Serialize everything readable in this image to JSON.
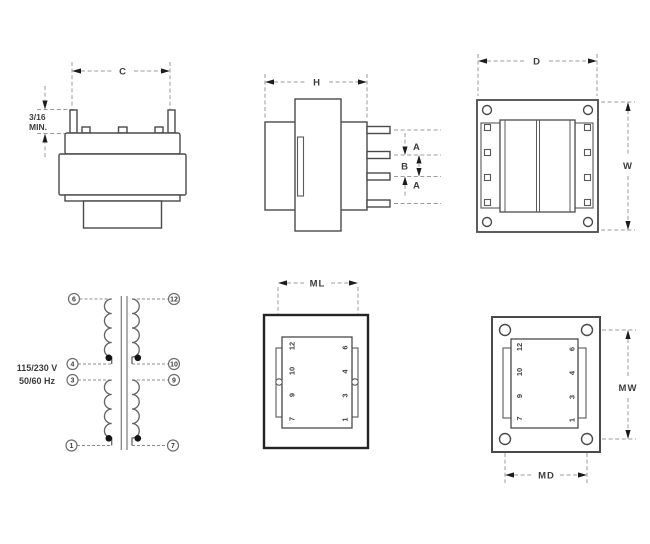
{
  "drawing": {
    "front_view": {
      "dim_width_label": "C",
      "min_lead_label_line1": "3/16",
      "min_lead_label_line2": "MIN."
    },
    "side_view": {
      "dim_length_label": "H",
      "pin_pitch_a_label": "A",
      "pin_pitch_b_label": "B"
    },
    "top_view": {
      "dim_depth_label": "D",
      "dim_width_label": "W"
    },
    "bottom_view_pins": {
      "dim_label": "ML"
    },
    "bottom_view_mounting": {
      "dim_width_label": "MW",
      "dim_depth_label": "MD"
    },
    "schematic": {
      "rating_line1": "115/230 V",
      "rating_line2": "50/60 Hz"
    },
    "pins": {
      "p1": "1",
      "p3": "3",
      "p4": "4",
      "p6": "6",
      "p7": "7",
      "p9": "9",
      "p10": "10",
      "p12": "12"
    },
    "colors": {
      "outline": "#4a4a4a",
      "dimension": "#9b9b9b",
      "arrow": "#1c1c1c",
      "text": "#3d3d3d",
      "background": "#ffffff"
    }
  }
}
